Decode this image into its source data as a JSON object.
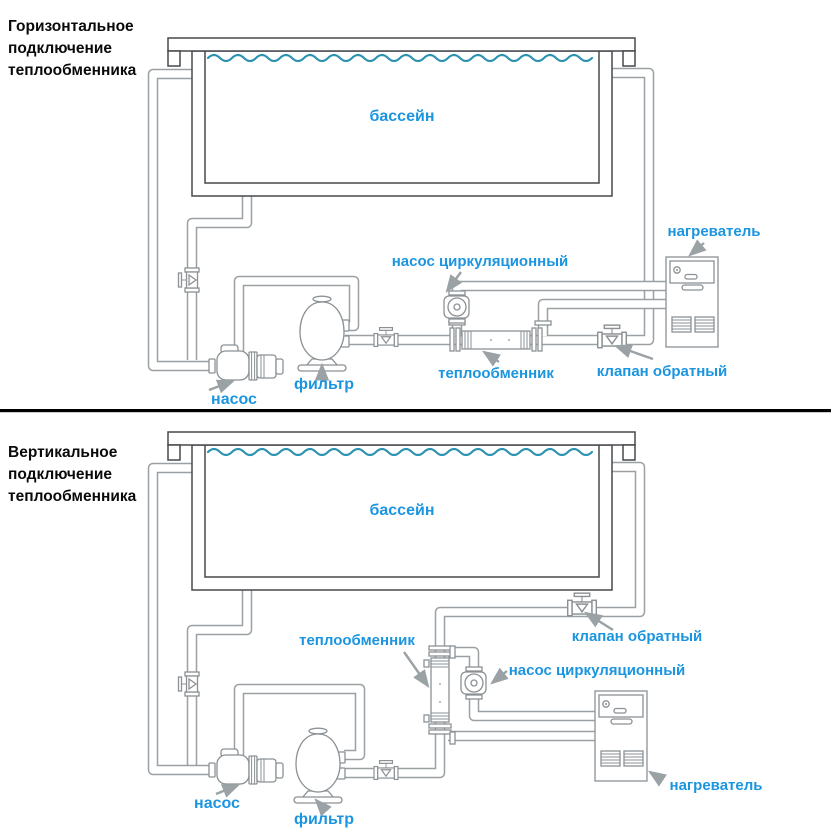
{
  "colors": {
    "blue": "#1b95e0",
    "water": "#2e93b0",
    "pipe": "#9aa0a3",
    "component": "#8b9194",
    "dark": "#46494c",
    "arrow": "#9aa2a6",
    "title": "#0a0a0a",
    "divider": "#000000"
  },
  "top_diagram": {
    "title_lines": [
      "Горизонтальное",
      "подключение",
      "теплообменника"
    ],
    "labels": {
      "pool": "бассейн",
      "circulation_pump": "насос циркуляционный",
      "heater": "нагреватель",
      "heat_exchanger": "теплообменник",
      "check_valve": "клапан обратный",
      "filter": "фильтр",
      "pump": "насос"
    }
  },
  "bottom_diagram": {
    "title_lines": [
      "Вертикальное",
      "подключение",
      "теплообменника"
    ],
    "labels": {
      "pool": "бассейн",
      "circulation_pump": "насос циркуляционный",
      "heater": "нагреватель",
      "heat_exchanger": "теплообменник",
      "check_valve": "клапан обратный",
      "filter": "фильтр",
      "pump": "насос"
    }
  }
}
